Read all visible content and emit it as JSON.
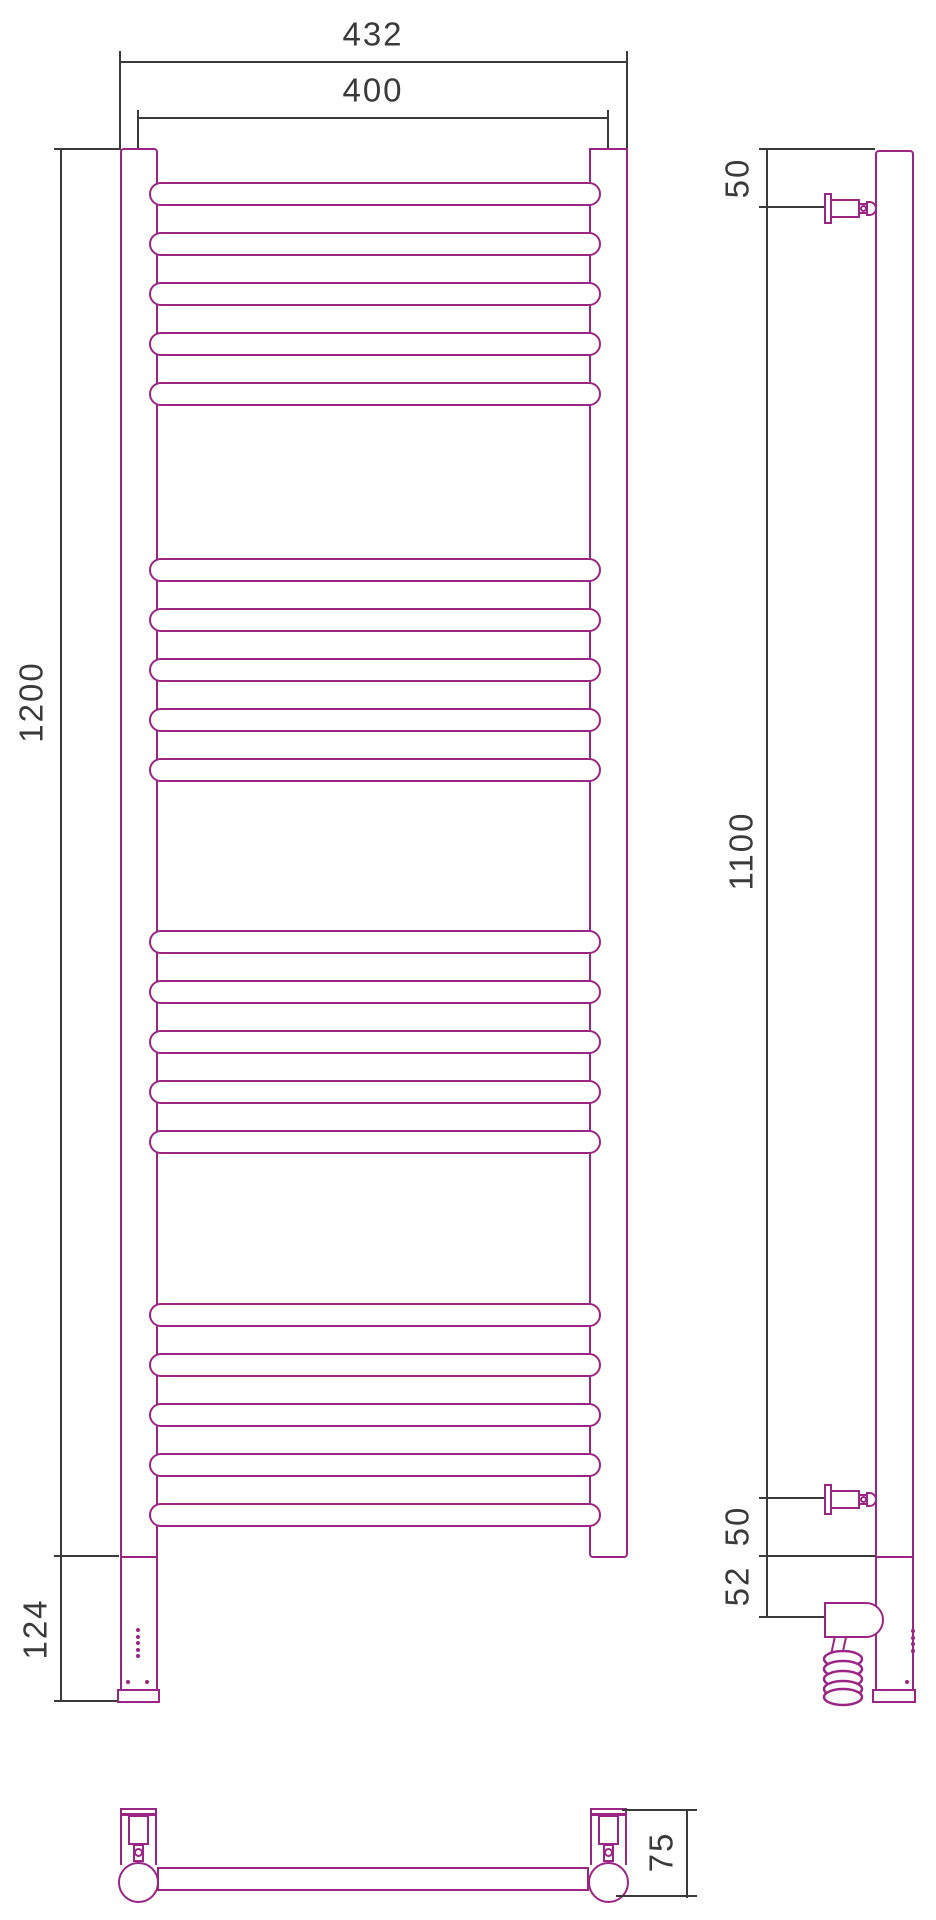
{
  "drawing": {
    "type": "technical-dimension-drawing",
    "subject": "ladder towel rail radiator, front / side / top views",
    "outline_color": "#9b2585",
    "dimension_color": "#3a3a3a",
    "front_view": {
      "overall_width": "432",
      "axis_width": "400",
      "height": "1200",
      "control_box_height": "124",
      "rung_group_count": 4,
      "rungs_per_group": 5,
      "indicator_dot_count": 5
    },
    "side_view": {
      "top_bracket_offset": "50",
      "bracket_span": "1100",
      "bottom_bracket_offset": "50",
      "element_axis_offset": "52"
    },
    "top_view": {
      "depth": "75"
    }
  }
}
